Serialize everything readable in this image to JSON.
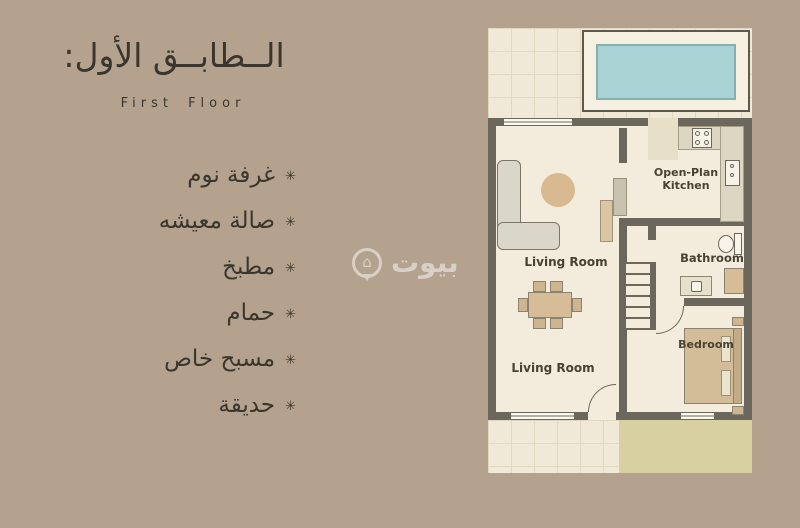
{
  "colors": {
    "bg": "#b4a28f",
    "ink": "#3a362d",
    "floor": "#f3ecdc",
    "wall": "#6b675c",
    "pool": "#a9d3d5",
    "garden": "#d8d0a0",
    "wood": "#d7bd97",
    "label": "#474234"
  },
  "panel": {
    "title_ar": "الــطابــق الأول:",
    "subtitle_en": "First Floor",
    "bullet": "✳",
    "items": [
      "غرفة نوم",
      "صالة معيشه",
      "مطبخ",
      "حمام",
      "مسبح خاص",
      "حديقة"
    ]
  },
  "floorplan": {
    "labels": {
      "kitchen": "Open-Plan Kitchen",
      "living_upper": "Living Room",
      "living_lower": "Living Room",
      "bathroom": "Bathroom",
      "bedroom": "Bedroom"
    }
  },
  "watermark": {
    "brand_ar": "بيوت"
  }
}
